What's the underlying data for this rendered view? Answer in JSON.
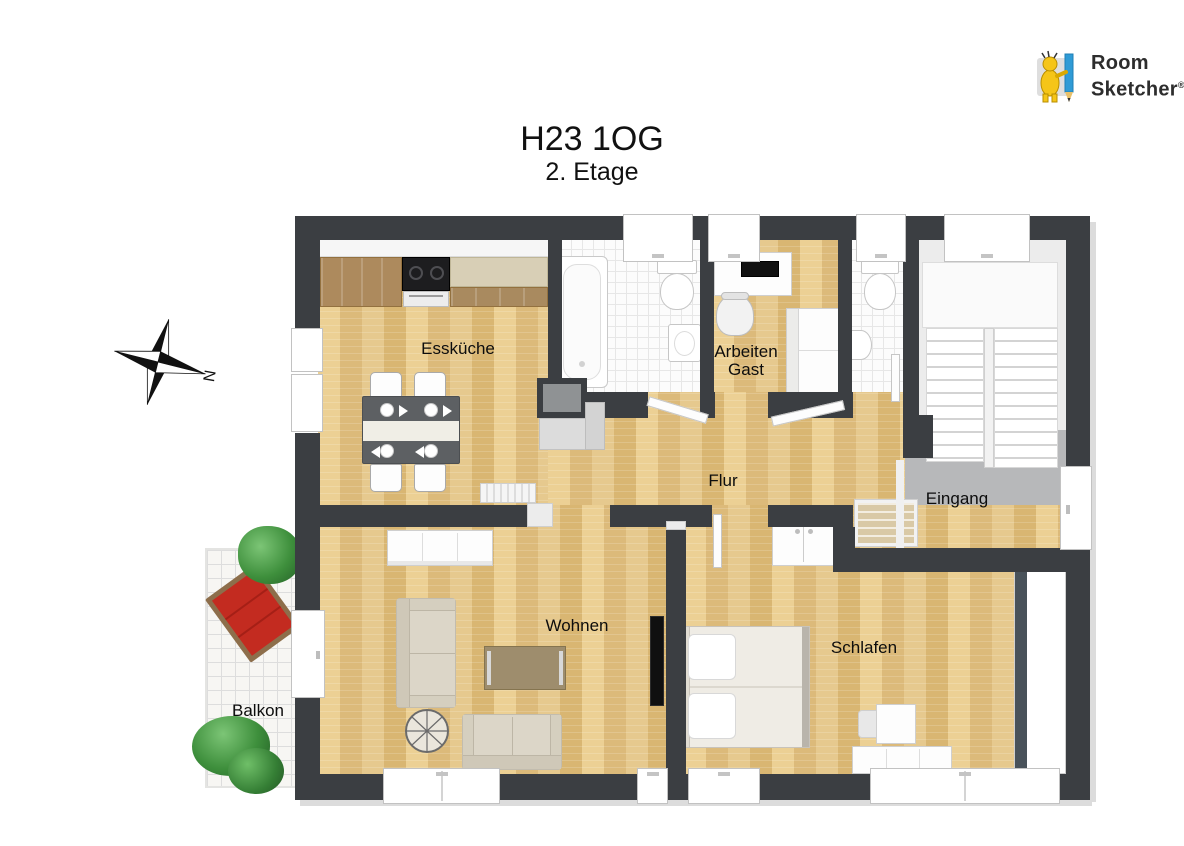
{
  "title": "H23 1OG",
  "subtitle": "2. Etage",
  "logo": {
    "line1": "Room",
    "line2": "Sketcher",
    "registered": "®"
  },
  "compass": {
    "north_label": "N"
  },
  "rooms": {
    "esskueche": {
      "label": "Essküche"
    },
    "arbeiten_gast": {
      "label_line1": "Arbeiten",
      "label_line2": "Gast"
    },
    "flur": {
      "label": "Flur"
    },
    "eingang": {
      "label": "Eingang"
    },
    "wohnen": {
      "label": "Wohnen"
    },
    "schlafen": {
      "label": "Schlafen"
    },
    "balkon": {
      "label": "Balkon"
    }
  },
  "colors": {
    "wall": "#3b3e42",
    "wood_floor": "#e4c488",
    "tile_grid": "#e7e7e7",
    "entry_floor": "#b7b8ba",
    "lounger_red": "#c32b20",
    "plant_green": "#3e8f3c",
    "logo_yellow": "#f5c518",
    "logo_blue": "#2f9bd6"
  }
}
